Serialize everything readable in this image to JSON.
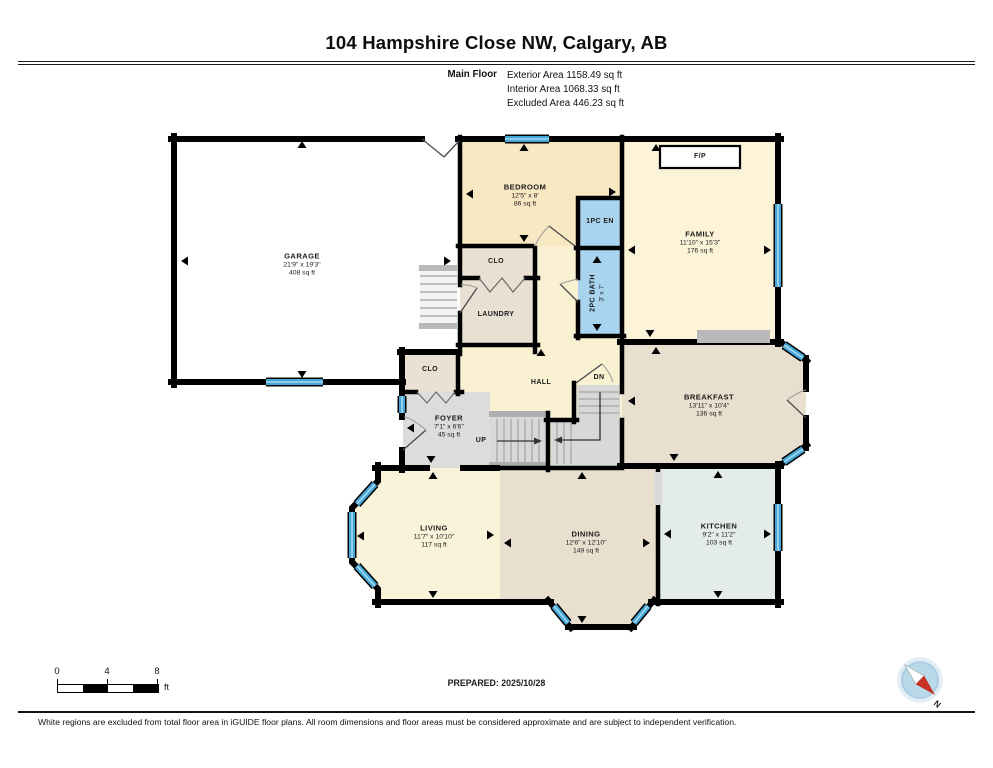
{
  "header": {
    "title": "104 Hampshire Close NW, Calgary, AB",
    "floor_label": "Main Floor",
    "stats": [
      "Exterior Area 1158.49 sq ft",
      "Interior Area 1068.33 sq ft",
      "Excluded Area 446.23 sq ft"
    ]
  },
  "rooms": {
    "garage": {
      "name": "GARAGE",
      "dims": "21'9\" x 19'3\"",
      "area": "408 sq ft"
    },
    "bedroom": {
      "name": "BEDROOM",
      "dims": "12'5\" x 8'",
      "area": "86 sq ft"
    },
    "ensuite": {
      "name": "1PC EN"
    },
    "family": {
      "name": "FAMILY",
      "dims": "11'10\" x 15'3\"",
      "area": "176 sq ft"
    },
    "fireplace": {
      "name": "F/P"
    },
    "closet_upper": {
      "name": "CLO"
    },
    "laundry": {
      "name": "LAUNDRY"
    },
    "bath": {
      "name": "2PC BATH",
      "dims": "3' x 7'"
    },
    "closet_lower": {
      "name": "CLO"
    },
    "foyer": {
      "name": "FOYER",
      "dims": "7'1\" x 6'6\"",
      "area": "45 sq ft"
    },
    "hall": {
      "name": "HALL"
    },
    "stairs_up": {
      "name": "UP"
    },
    "stairs_dn": {
      "name": "DN"
    },
    "breakfast": {
      "name": "BREAKFAST",
      "dims": "13'11\" x 10'4\"",
      "area": "136 sq ft"
    },
    "living": {
      "name": "LIVING",
      "dims": "11'7\" x 10'10\"",
      "area": "117 sq ft"
    },
    "dining": {
      "name": "DINING",
      "dims": "12'6\" x 12'10\"",
      "area": "149 sq ft"
    },
    "kitchen": {
      "name": "KITCHEN",
      "dims": "9'2\" x 11'2\"",
      "area": "103 sq ft"
    }
  },
  "footer": {
    "scale_ticks": [
      "0",
      "4",
      "8"
    ],
    "scale_unit": "ft",
    "prepared": "PREPARED: 2025/10/28",
    "compass_n": "N",
    "disclaimer": "White regions are excluded from total floor area in iGUIDE floor plans. All room dimensions and floor areas must be considered approximate and are subject to independent verification."
  },
  "colors": {
    "wall": "#000000",
    "window_blue": "#45a7d8",
    "bath_blue": "#a9d4ef",
    "cream_hall": "#f9f1d2",
    "cream_family": "#fcf3d8",
    "tan_bedroom": "#f8e8c2",
    "beige_dining": "#e9dfcf",
    "beige_breakfast": "#e8dfce",
    "kitchen_green": "#e3ece7",
    "closet_tan": "#eae1d3",
    "foyer_gray": "#dcdcda",
    "stair_gray": "#d8d8d6",
    "hearth_gray": "#b9b9b9",
    "compass_fill": "#badae9",
    "compass_red": "#c63026"
  }
}
